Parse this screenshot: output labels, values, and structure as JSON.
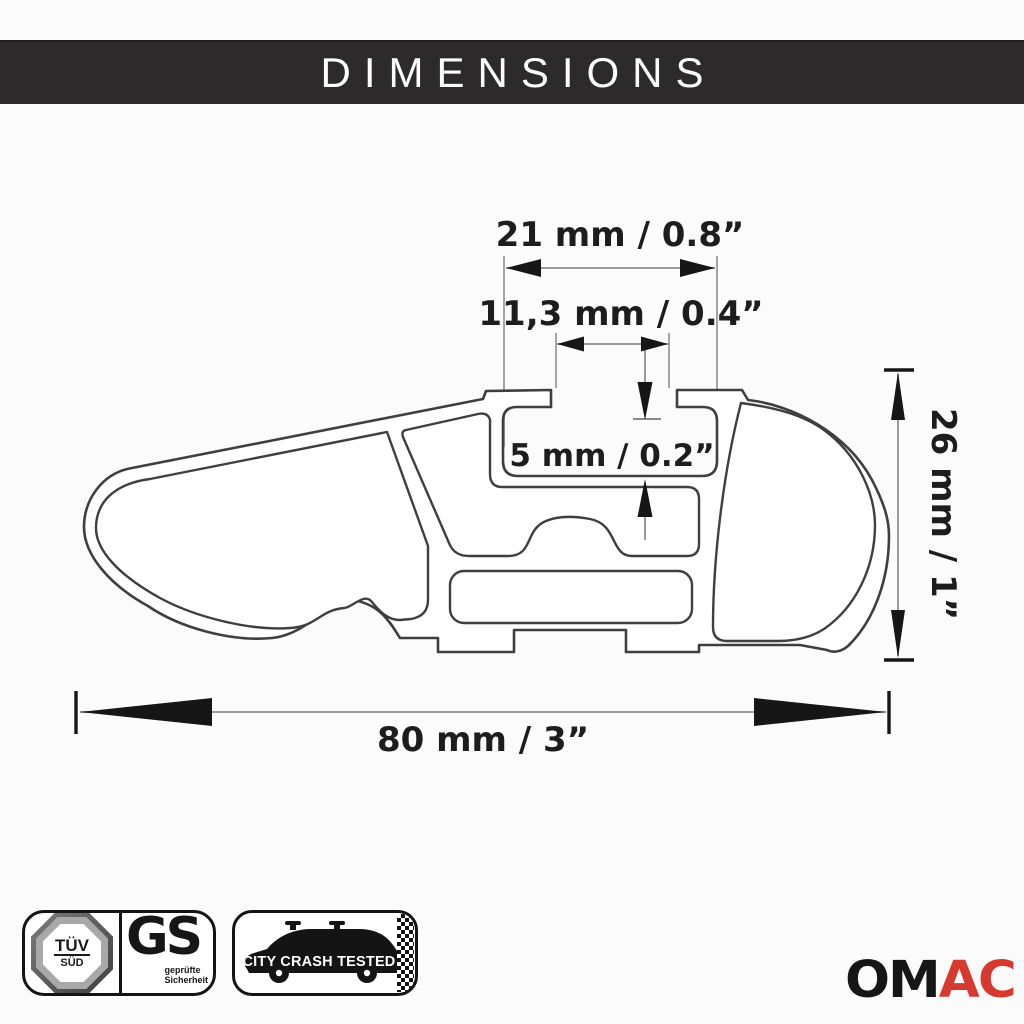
{
  "header": {
    "title": "DIMENSIONS"
  },
  "diagram": {
    "dim_top_width": "21 mm / 0.8”",
    "dim_slot_width": "11,3 mm / 0.4”",
    "dim_slot_depth": "5 mm / 0.2”",
    "dim_height": "26 mm / 1”",
    "dim_total_width": "80 mm / 3”"
  },
  "badges": {
    "tuv": {
      "line1": "TÜV",
      "line2": "SÜD"
    },
    "gs": {
      "label": "GS",
      "sub1": "geprüfte",
      "sub2": "Sicherheit"
    },
    "crash": {
      "label": "CITY CRASH TESTED"
    }
  },
  "brand": {
    "om": "OM",
    "ac": "AC"
  },
  "colors": {
    "header_bg": "#2d2a2c",
    "line": "#3f3f3f",
    "dim_line": "#9a9a9a",
    "arrow": "#161616",
    "brand_red": "#d63a2f"
  }
}
